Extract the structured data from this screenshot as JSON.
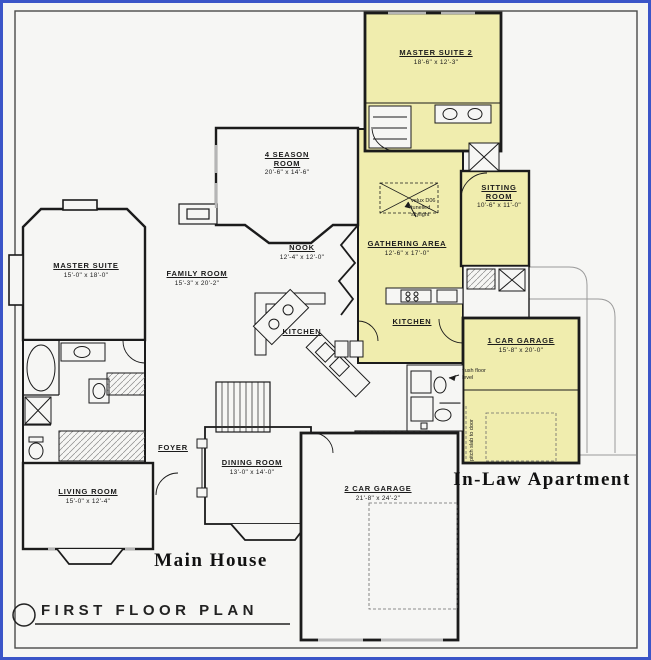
{
  "colors": {
    "blue_border": "#3b55c8",
    "background": "#f6f6f4",
    "wall": "#1b1b1b",
    "inlaw_fill": "#f0edae",
    "gray_line": "#9a9a9a"
  },
  "title": "FIRST FLOOR PLAN",
  "section_labels": {
    "main_house": "Main House",
    "inlaw_apartment": "In-Law Apartment"
  },
  "rooms": [
    {
      "id": "master-suite-2",
      "name": "MASTER SUITE 2",
      "dims": "18'-6\" x 12'-3\""
    },
    {
      "id": "four-season-room",
      "name": "4 SEASON ROOM",
      "dims": "20'-6\" x 14'-6\""
    },
    {
      "id": "sitting-room",
      "name": "SITTING ROOM",
      "dims": "10'-6\" x 11'-0\""
    },
    {
      "id": "gathering-area",
      "name": "GATHERING AREA",
      "dims": "12'-6\" x 17'-0\""
    },
    {
      "id": "master-suite",
      "name": "MASTER SUITE",
      "dims": "15'-0\" x 18'-0\""
    },
    {
      "id": "family-room",
      "name": "FAMILY ROOM",
      "dims": "15'-3\" x 20'-2\""
    },
    {
      "id": "nook",
      "name": "NOOK",
      "dims": "12'-4\" x 12'-0\""
    },
    {
      "id": "kitchen-main",
      "name": "KITCHEN",
      "dims": ""
    },
    {
      "id": "kitchen-inlaw",
      "name": "KITCHEN",
      "dims": ""
    },
    {
      "id": "one-car-garage",
      "name": "1 CAR GARAGE",
      "dims": "15'-8\" x 20'-0\""
    },
    {
      "id": "foyer",
      "name": "FOYER",
      "dims": ""
    },
    {
      "id": "dining-room",
      "name": "DINING ROOM",
      "dims": "13'-0\" x 14'-0\""
    },
    {
      "id": "living-room",
      "name": "LIVING ROOM",
      "dims": "15'-0\" x 12'-4\""
    },
    {
      "id": "two-car-garage",
      "name": "2 CAR GARAGE",
      "dims": "21'-8\" x 24'-2\""
    }
  ],
  "annotations": {
    "skylight": "velux D06\ntunelled\nskylight",
    "flush_floor": "flush floor\nlevel",
    "pitch_slab": "pitch slab to door"
  }
}
